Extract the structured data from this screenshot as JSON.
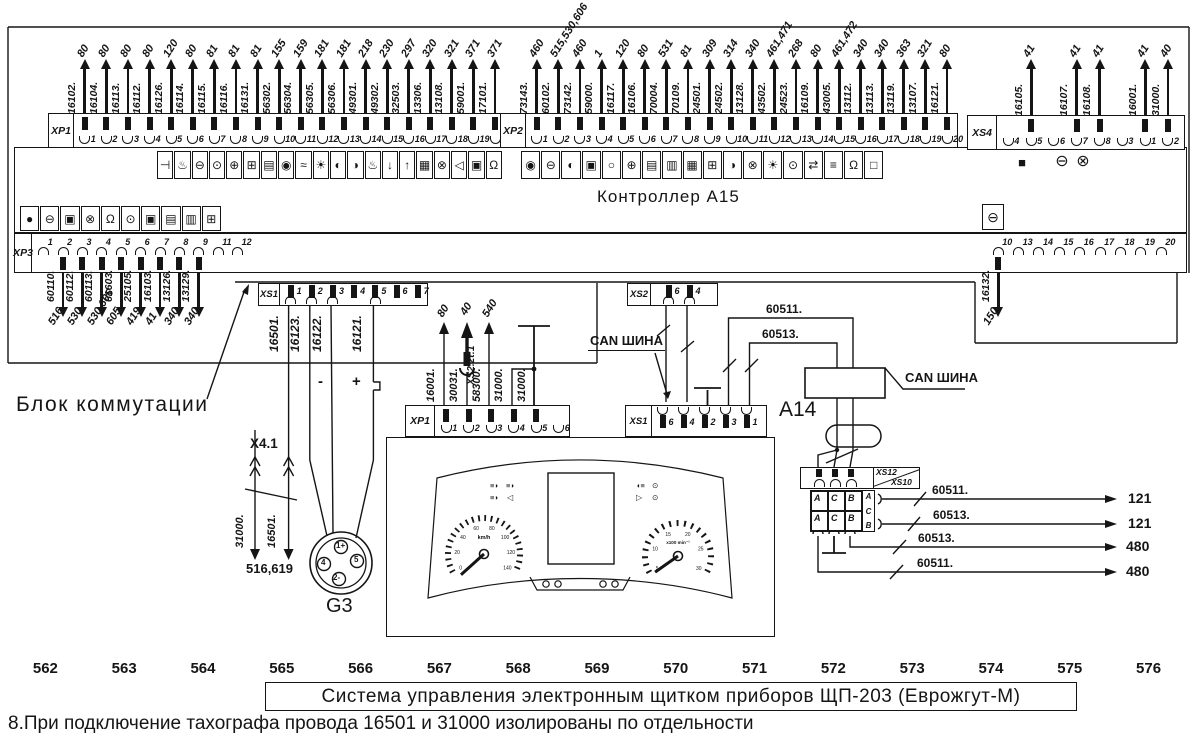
{
  "title_block": {
    "scale_numbers": [
      "562",
      "563",
      "564",
      "565",
      "566",
      "567",
      "568",
      "569",
      "570",
      "571",
      "572",
      "573",
      "574",
      "575",
      "576"
    ],
    "title": "Система управления электронным щитком приборов ЩП-203 (Еврожгут-М)",
    "note": "8.При подключение тахографа провода 16501 и 31000 изолированы по отдельности"
  },
  "controller": {
    "label": "Контроллер А15",
    "icons_row1a": [
      "⊣",
      "♨",
      "⊖",
      "⊙",
      "⊕",
      "⊞",
      "▤",
      "◉",
      "≈",
      "☀",
      "◐",
      "◑",
      "♨",
      "↓",
      "↑",
      "▦",
      "⊗",
      "◁",
      "▣",
      "Ω"
    ],
    "icons_row1b": [
      "◉",
      "⊖",
      "◐",
      "▣",
      "○",
      "⊕",
      "▤",
      "▥",
      "▦",
      "⊞",
      "◑",
      "⊗",
      "☀",
      "⊙",
      "⇄",
      "≡",
      "Ω",
      "□"
    ],
    "icons_row2": [
      "●",
      "⊖",
      "▣",
      "⊗",
      "Ω",
      "⊙",
      "▣",
      "▤",
      "▥",
      "⊞"
    ],
    "xs4_icons": [
      "■",
      "⊖",
      "⊗"
    ],
    "single_icon": "⊖"
  },
  "connectors": {
    "xp1": {
      "label": "XP1",
      "pins": [
        {
          "n": "1",
          "wire": "16102.",
          "dest": "80"
        },
        {
          "n": "2",
          "wire": "16104.",
          "dest": "80"
        },
        {
          "n": "3",
          "wire": "16113.",
          "dest": "80"
        },
        {
          "n": "4",
          "wire": "16112.",
          "dest": "80"
        },
        {
          "n": "5",
          "wire": "16126.",
          "dest": "120"
        },
        {
          "n": "6",
          "wire": "16114.",
          "dest": "80"
        },
        {
          "n": "7",
          "wire": "16115.",
          "dest": "81"
        },
        {
          "n": "8",
          "wire": "16116.",
          "dest": "81"
        },
        {
          "n": "9",
          "wire": "16131.",
          "dest": "81"
        },
        {
          "n": "10",
          "wire": "56302.",
          "dest": "155"
        },
        {
          "n": "11",
          "wire": "56304.",
          "dest": "159"
        },
        {
          "n": "12",
          "wire": "56305.",
          "dest": "181"
        },
        {
          "n": "13",
          "wire": "56306.",
          "dest": "181"
        },
        {
          "n": "14",
          "wire": "49301.",
          "dest": "218"
        },
        {
          "n": "15",
          "wire": "49302.",
          "dest": "230"
        },
        {
          "n": "16",
          "wire": "32503.",
          "dest": "297"
        },
        {
          "n": "17",
          "wire": "13306.",
          "dest": "320"
        },
        {
          "n": "18",
          "wire": "13108.",
          "dest": "321"
        },
        {
          "n": "19",
          "wire": "59001.",
          "dest": "371"
        },
        {
          "n": "20",
          "wire": "17101.",
          "dest": "371"
        }
      ]
    },
    "xp2": {
      "label": "XP2",
      "pins": [
        {
          "n": "1",
          "wire": "73143.",
          "dest": "460"
        },
        {
          "n": "2",
          "wire": "60102.",
          "dest": "515,530,606"
        },
        {
          "n": "3",
          "wire": "73142.",
          "dest": "460"
        },
        {
          "n": "4",
          "wire": "59000.",
          "dest": "1"
        },
        {
          "n": "5",
          "wire": "16117.",
          "dest": "120"
        },
        {
          "n": "6",
          "wire": "16106.",
          "dest": "80"
        },
        {
          "n": "7",
          "wire": "70004.",
          "dest": "531"
        },
        {
          "n": "8",
          "wire": "70109.",
          "dest": "81"
        },
        {
          "n": "9",
          "wire": "24501.",
          "dest": "309"
        },
        {
          "n": "10",
          "wire": "24502.",
          "dest": "314"
        },
        {
          "n": "11",
          "wire": "13128.",
          "dest": "340"
        },
        {
          "n": "12",
          "wire": "43502.",
          "dest": "461,471"
        },
        {
          "n": "13",
          "wire": "24523.",
          "dest": "268"
        },
        {
          "n": "14",
          "wire": "16109.",
          "dest": "80"
        },
        {
          "n": "15",
          "wire": "43005.",
          "dest": "461,472"
        },
        {
          "n": "16",
          "wire": "13112.",
          "dest": "340"
        },
        {
          "n": "17",
          "wire": "13113.",
          "dest": "340"
        },
        {
          "n": "18",
          "wire": "13119.",
          "dest": "363"
        },
        {
          "n": "19",
          "wire": "13107.",
          "dest": "321"
        },
        {
          "n": "20",
          "wire": "16121.",
          "dest": "80"
        }
      ]
    },
    "xs4": {
      "label": "XS4",
      "pins": [
        {
          "n": "4"
        },
        {
          "n": "5",
          "wire": "16105.",
          "dest": "41"
        },
        {
          "n": "6"
        },
        {
          "n": "7",
          "wire": "16107.",
          "dest": "41"
        },
        {
          "n": "8",
          "wire": "16108.",
          "dest": "41"
        },
        {
          "n": "3"
        },
        {
          "n": "1",
          "wire": "16001.",
          "dest": "41"
        },
        {
          "n": "2",
          "wire": "31000.",
          "dest": "40"
        }
      ]
    },
    "xp3": {
      "label": "XP3",
      "left_pins": [
        {
          "n": "1"
        },
        {
          "n": "2",
          "wire": "60110.",
          "dest": "516"
        },
        {
          "n": "3",
          "wire": "60112.",
          "dest": "530"
        },
        {
          "n": "4",
          "wire": "60113.",
          "dest": "530,606"
        },
        {
          "n": "5",
          "wire": "61603.",
          "dest": "605"
        },
        {
          "n": "6",
          "wire": "25105.",
          "dest": "419"
        },
        {
          "n": "7",
          "wire": "16103.",
          "dest": "41"
        },
        {
          "n": "8",
          "wire": "13126.",
          "dest": "340"
        },
        {
          "n": "9",
          "wire": "13129.",
          "dest": "340"
        },
        {
          "n": "11"
        },
        {
          "n": "12"
        }
      ],
      "right_pins": [
        {
          "n": "10",
          "wire": "16132.",
          "dest": "150"
        },
        {
          "n": "13"
        },
        {
          "n": "14"
        },
        {
          "n": "15"
        },
        {
          "n": "16"
        },
        {
          "n": "17"
        },
        {
          "n": "18"
        },
        {
          "n": "19"
        },
        {
          "n": "20"
        }
      ]
    },
    "xs1_mid": {
      "label": "XS1",
      "pins": [
        {
          "n": "1",
          "term": true,
          "arc": true
        },
        {
          "n": "2",
          "term": true,
          "arc": true
        },
        {
          "n": "3",
          "term": true,
          "arc": true
        },
        {
          "n": "4",
          "term": true
        },
        {
          "n": "5",
          "term": true,
          "arc": true
        },
        {
          "n": "6",
          "term": true
        },
        {
          "n": "7",
          "term": true
        }
      ]
    },
    "xs2": {
      "label": "XS2",
      "pins": [
        {
          "n": "6",
          "term": true,
          "arc": true
        },
        {
          "n": "4",
          "term": true,
          "arc": true
        }
      ]
    },
    "cluster_xp1": {
      "label": "XP1",
      "pins": [
        {
          "n": "1",
          "term": true,
          "arc": true
        },
        {
          "n": "2",
          "term": true,
          "arc": true
        },
        {
          "n": "3",
          "term": true,
          "arc": true
        },
        {
          "n": "4",
          "term": true,
          "arc": true
        },
        {
          "n": "5",
          "term": true,
          "arc": true
        },
        {
          "n": "6",
          "arc": true
        }
      ]
    },
    "cluster_xs1": {
      "label": "XS1",
      "pins": [
        {
          "n": "6",
          "term": true,
          "arc": true
        },
        {
          "n": "4",
          "term": true,
          "arc": true
        },
        {
          "n": "2",
          "term": true,
          "arc": true
        },
        {
          "n": "3",
          "term": true,
          "arc": true
        },
        {
          "n": "1",
          "term": true,
          "arc": true
        }
      ]
    },
    "xs12": {
      "label_top": "XS12",
      "label_bottom": "XS10",
      "pins": [
        {
          "term": true,
          "arc": true
        },
        {
          "term": true,
          "arc": true
        },
        {
          "term": true,
          "arc": true
        }
      ]
    }
  },
  "free_labels": {
    "blok": "Блок коммутации",
    "a14": "А14",
    "g3": "G3",
    "x41": "X4.1",
    "iso_dest": "516,619",
    "w31000": "31000.",
    "w16501b": "16501.",
    "xs1w1": "16501.",
    "xs1w2": "16123.",
    "xs1w3": "16122.",
    "xs1w5": "16121.",
    "minus": "-",
    "plus": "+",
    "can1": "CAN ШИНА",
    "can2": "CAN ШИНА",
    "w60511": "60511.",
    "w60513": "60513.",
    "cl_w16001": "16001.",
    "cl_w30031": "30031.",
    "cl_via": "XS2.2t:1",
    "cl_w58300": "58300.",
    "cl_w31000a": "31000.",
    "cl_w31000b": "31000.",
    "cl_d80": "80",
    "cl_d40": "40",
    "cl_d540": "540"
  },
  "right_outputs": [
    {
      "wire": "60511.",
      "dest": "121"
    },
    {
      "wire": "60513.",
      "dest": "121"
    },
    {
      "wire": "60513.",
      "dest": "480"
    },
    {
      "wire": "60511.",
      "dest": "480"
    }
  ],
  "abc": [
    "A",
    "C",
    "B"
  ],
  "g3_pins": [
    "1+",
    "4",
    "5",
    "2-"
  ],
  "cluster": {
    "speed_unit": "km/h",
    "tach_unit": "x100 min⁻¹",
    "speed_ticks": [
      "0",
      "20",
      "40",
      "60",
      "80",
      "100",
      "120",
      "140"
    ],
    "tach_ticks": [
      "5",
      "10",
      "15",
      "20",
      "25",
      "30"
    ]
  }
}
